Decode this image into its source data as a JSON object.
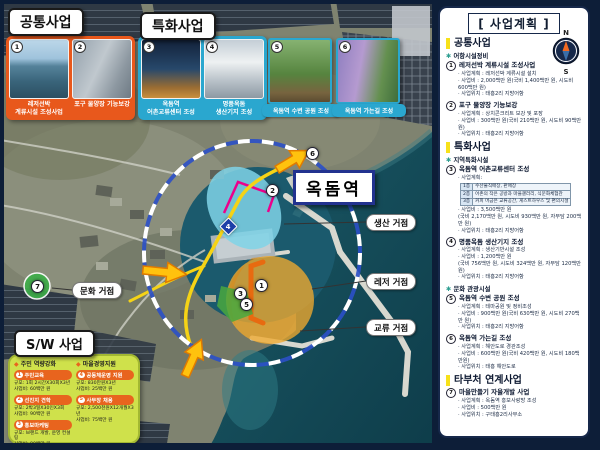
{
  "colors": {
    "panel_orange": "#E8581C",
    "panel_cyan": "#2AA7CF",
    "sw_green": "#CFE14B",
    "navy": "#16284A",
    "road_yellow": "#F5D316",
    "arrow_orange": "#FFC20E",
    "highlight_magenta": "#EC008C",
    "area_cyan": "#7FD4E8",
    "area_orange": "#F0A92E",
    "header_yellow": "#F7E11A"
  },
  "common": {
    "title": "공통사업",
    "items": [
      {
        "num": "1",
        "cap1": "레저선박",
        "cap2": "계류시설 조성사업"
      },
      {
        "num": "2",
        "cap1": "포구 물양장 기능보강",
        "cap2": ""
      }
    ]
  },
  "special": {
    "title": "특화사업",
    "items": [
      {
        "num": "3",
        "cap1": "옥돔역",
        "cap2": "어촌교류센터 조성"
      },
      {
        "num": "4",
        "cap1": "명품옥돔",
        "cap2": "생산기지 조성"
      },
      {
        "num": "5",
        "cap1": "옥돔역 수변 공원 조성"
      },
      {
        "num": "6",
        "cap1": "옥돔역 가는길 조성"
      }
    ]
  },
  "map": {
    "station": "옥돔역",
    "hubs": [
      {
        "label": "생산 거점"
      },
      {
        "label": "레저 거점"
      },
      {
        "label": "교류 거점"
      },
      {
        "label": "문화 거점"
      }
    ],
    "markers": [
      {
        "n": "1"
      },
      {
        "n": "2"
      },
      {
        "n": "3"
      },
      {
        "n": "4"
      },
      {
        "n": "5"
      },
      {
        "n": "6"
      },
      {
        "n": "7"
      }
    ],
    "compass": {
      "n": "N",
      "s": "S"
    }
  },
  "sw": {
    "title": "S/W 사업",
    "col1": {
      "header": "주민 역량강화",
      "items": [
        {
          "n": "1",
          "name": "주민교육",
          "scale": "규모: 1회 2시간X30회X3년",
          "cost": "사업비: 60백만 원"
        },
        {
          "n": "2",
          "name": "선진지 견학",
          "scale": "규모: 2박3일X30인X3회",
          "cost": "사업비: 90백만 원"
        },
        {
          "n": "3",
          "name": "홍보마케팅",
          "scale": "규모: 브랜드 개발, 운영 컨설팅",
          "cost": "사업비: 80백만 원"
        }
      ]
    },
    "col2": {
      "header": "마을경영지원",
      "items": [
        {
          "n": "4",
          "name": "공동체운영 지원",
          "scale": "규모: 830만원X3년",
          "cost": "사업비: 25백만 원"
        },
        {
          "n": "5",
          "name": "사무장 채용",
          "scale": "규모: 2,500천원X12개월X3년",
          "cost": "사업비: 75백만 원"
        }
      ]
    }
  },
  "plan": {
    "title": "[ 사업계획 ]",
    "sections": {
      "s1": "공통사업",
      "s2": "특화사업",
      "s3": "타부처 연계사업"
    },
    "bullets": {
      "b1": {
        "star": "✱",
        "label": "어항시설정비"
      },
      "b2": {
        "star": "✱",
        "label": "지역특화시설"
      },
      "b3": {
        "star": "✱",
        "label": "문화 관광시설"
      }
    },
    "items": [
      {
        "n": "1",
        "title": "레저선박 계류시설 조성사업",
        "lines": [
          "· 사업계획 : 레저선박 계류시설 설치",
          "· 사업비 : 2,000백만 원(국비 1,400백만 원, 시도비 600백만 원)",
          "· 사업위치 : 태흥2리 지방어항"
        ]
      },
      {
        "n": "2",
        "title": "포구 물양장 기능보강",
        "lines": [
          "· 사업계획 : 상치콘크리트 보강 및 포장",
          "· 사업비 : 300백만 원(국비 210백만 원, 시도비 90백만 원)",
          "· 사업위치 : 태흥2리 지방어항"
        ]
      },
      {
        "n": "3",
        "title": "옥돔역 어촌교류센터 조성",
        "plan_label": "· 사업계획:",
        "floors": [
          [
            "1층",
            "수산물직매장, 판매장"
          ],
          [
            "2층",
            "어촌의 작은 공방과 마을갤러리, 식문화체험관"
          ],
          [
            "3층",
            "커피 머금은 교류공간, 게스트하우스 및 편의시설"
          ]
        ],
        "lines": [
          "· 사업비 : 3,500백만 원",
          "(국비 2,170백만 원, 시도비 930백만 원, 자부담 200백만 원)",
          "· 사업위치 : 태흥2리 지방어항"
        ]
      },
      {
        "n": "4",
        "title": "명품옥돔 생산기지 조성",
        "lines": [
          "· 사업계획 : 생산기반시설 조성",
          "· 사업비 : 1,200백만 원",
          "(국비 756백만 원, 시도비 324백만 원, 자부담 120백만 원)",
          "· 사업위치 : 태흥2리 지방어항"
        ]
      },
      {
        "n": "5",
        "title": "옥돔역 수변 공원 조성",
        "lines": [
          "· 사업계획 : 테마공원 및 정비조성",
          "· 사업비 : 900백만 원(국비 630백만 원, 시도비 270백만 원)",
          "· 사업위치 : 태흥2리 지방어항"
        ]
      },
      {
        "n": "6",
        "title": "옥돔역 가는길 조성",
        "lines": [
          "· 사업계획 : 해안도로 경관조성",
          "· 사업비 : 600백만 원(국비 420백만 원, 시도비 180백만원)",
          "· 사업위치 : 태흥 해안도로"
        ]
      },
      {
        "n": "7",
        "title": "마을만들기 자율개발 사업",
        "lines": [
          "· 사업계획 : 옥돔역 홍보사랑방 조성",
          "· 사업비 : 500백만 원",
          "· 사업위치 : 구태흥2리사무소"
        ]
      }
    ]
  }
}
